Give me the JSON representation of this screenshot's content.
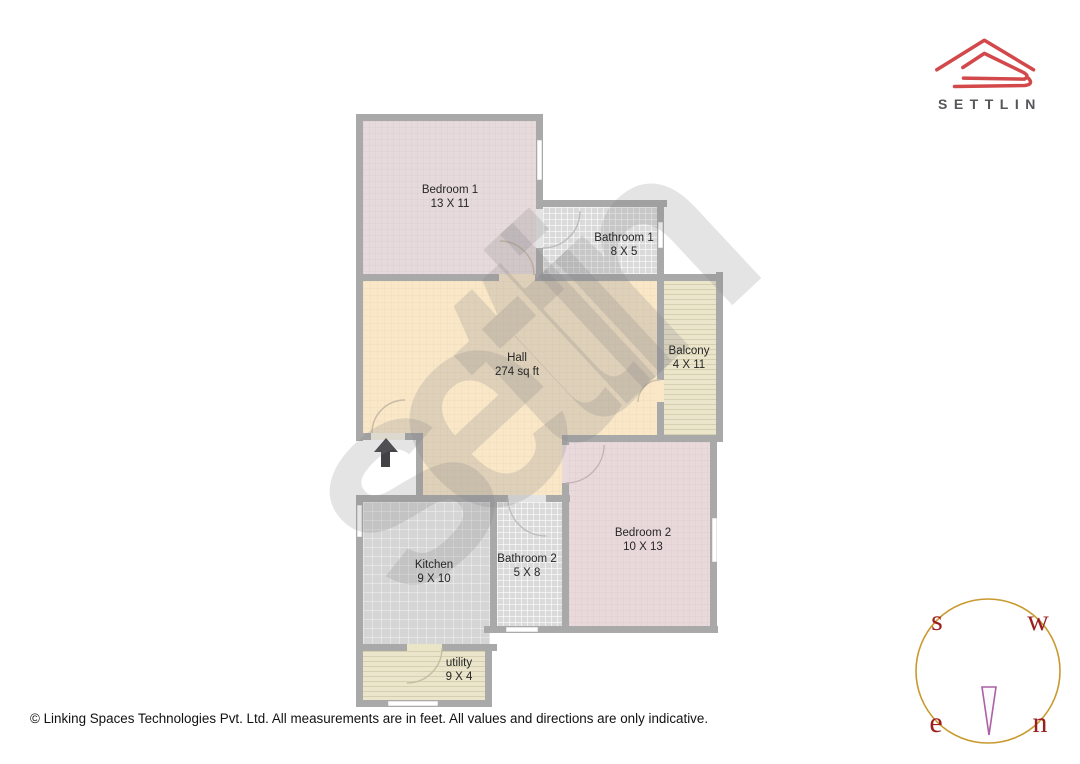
{
  "logo": {
    "brand": "SETTLIN",
    "accent_color": "#d2484b",
    "text_color": "#55555a"
  },
  "watermark": {
    "text": "settlin"
  },
  "floorplan": {
    "wall_color": "#a9a9a9",
    "rooms": [
      {
        "name": "Bedroom 1",
        "dims": "13 X 11",
        "color": "#e7dadc"
      },
      {
        "name": "Bathroom 1",
        "dims": "8 X 5",
        "color": "#dadada"
      },
      {
        "name": "Hall",
        "dims": "274 sq ft",
        "color": "#f9e7c7"
      },
      {
        "name": "Balcony",
        "dims": "4 X 11",
        "color": "#eae5cb"
      },
      {
        "name": "Bedroom 2",
        "dims": "10 X 13",
        "color": "#ead9db"
      },
      {
        "name": "Bathroom 2",
        "dims": "5 X 8",
        "color": "#dadada"
      },
      {
        "name": "Kitchen",
        "dims": "9 X 10",
        "color": "#d5d5d5"
      },
      {
        "name": "utility",
        "dims": "9 X 4",
        "color": "#eae5cb"
      }
    ]
  },
  "compass": {
    "letters": [
      "s",
      "w",
      "e",
      "n"
    ],
    "ring_color": "#c9992e",
    "letter_color": "#9c1f1f",
    "needle_color": "#ab61a3"
  },
  "footer": {
    "copyright": "© Linking Spaces Technologies Pvt. Ltd. All measurements are in feet. All values and directions are only indicative."
  }
}
